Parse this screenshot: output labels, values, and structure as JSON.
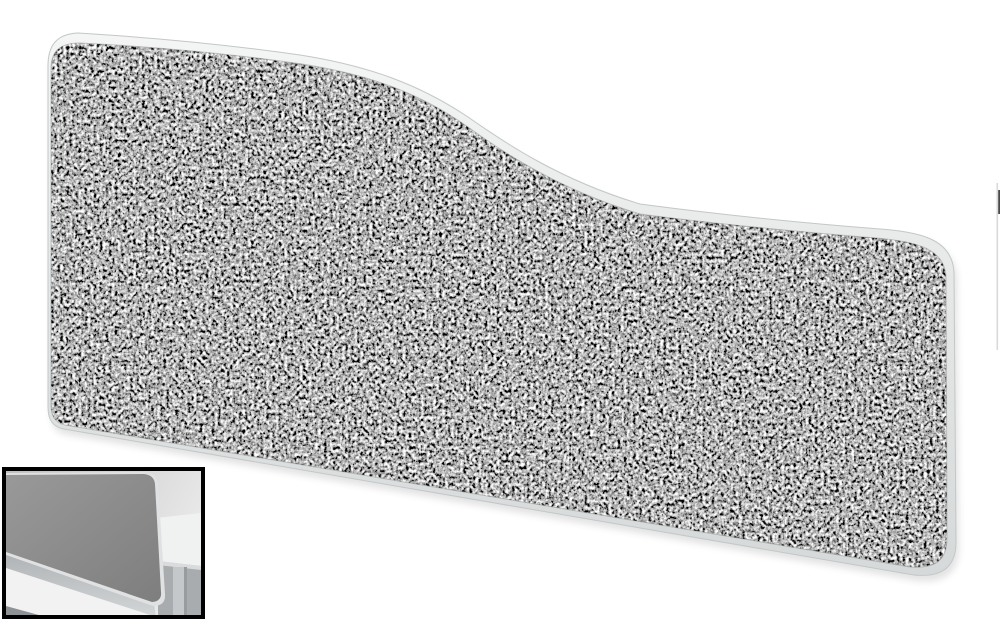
{
  "window": {
    "background": "#ffffff"
  },
  "product_photo": {
    "label": "wave-top-desktop-screen",
    "fabric": {
      "base": "#757575",
      "dark_fleck": "#1e1e1e",
      "light_fleck": "#e9e9e9"
    },
    "trim": {
      "fill_top": "#f4f5f5",
      "fill_bottom": "#d6d9d9",
      "edge": "#c3c7c7",
      "seam": "#8f9494"
    },
    "shadow": "#3c3c3c"
  },
  "right_edge_artifact": {
    "faint": "#d9d9d9",
    "dark": "#4a4a4a"
  },
  "inset": {
    "label": "desk-mounted-view-thumbnail",
    "border": "#000000",
    "background_left": "#bfbfbf",
    "background_right": "#e9e9e9",
    "screen_fill": "#8b8b8b",
    "screen_trim": "#dfe1e2",
    "desk_top": "#f0f1f1",
    "desk_edge": "#d9dbdc",
    "under_desk": "#a9acae",
    "leg": "#c4c8ca",
    "leg_shade": "#989c9e",
    "under_screen_strip": "#c0c4c6",
    "floor_wedge": "#f2f2f2",
    "corner_structure": "#8e9294"
  }
}
